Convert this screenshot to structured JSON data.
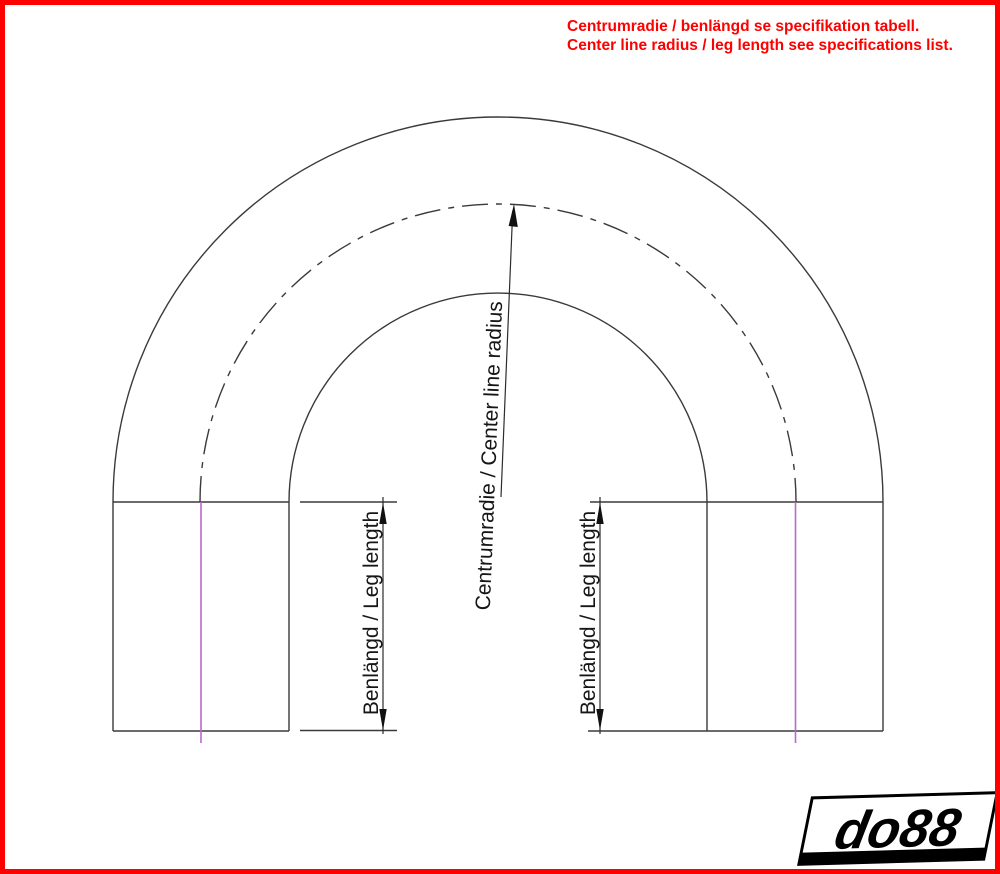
{
  "page": {
    "background": "#ffffff",
    "border_color": "#ff0000"
  },
  "notice": {
    "line1": "Centrumradie / benlängd se specifikation tabell.",
    "line2": "Center line radius / leg length see specifications list.",
    "color": "#ff0000"
  },
  "diagram": {
    "labels": {
      "center_line_radius": "Centrumradie / Center line radius",
      "leg_length_left": "Benlängd / Leg length",
      "leg_length_right": "Benlängd / Leg length"
    },
    "colors": {
      "line": "#3a3a3a",
      "centerline_magenta": "#bd66cf",
      "arrow": "#111111"
    }
  },
  "logo": {
    "text": "do88"
  }
}
